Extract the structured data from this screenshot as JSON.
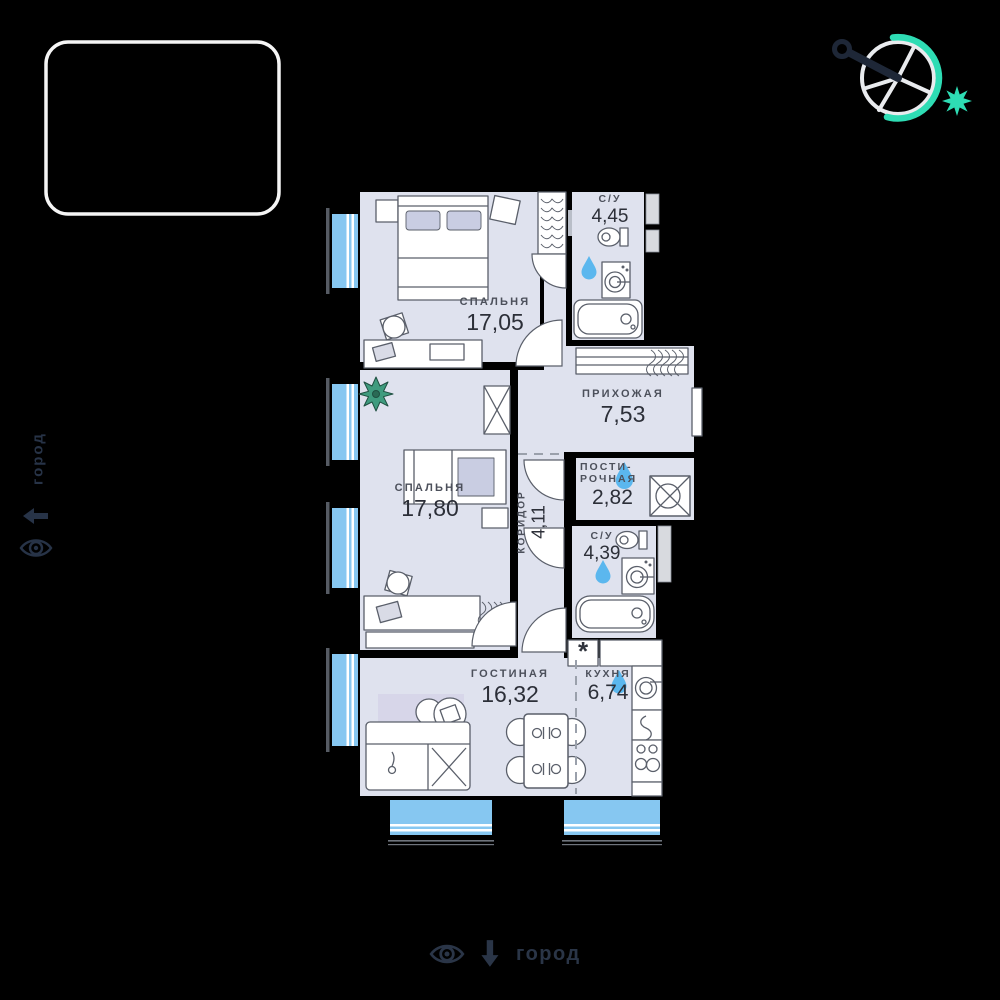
{
  "canvas": {
    "background": "#000000"
  },
  "compass": {
    "accent_color": "#2edcb4",
    "ring_color": "#e9ebee",
    "needle_color": "#1e2737"
  },
  "view_labels": {
    "left": {
      "text": "город"
    },
    "bottom": {
      "text": "город"
    }
  },
  "floorplan": {
    "colors": {
      "floor": "#dfe2ee",
      "wall": "#000000",
      "window": "#86c7f1",
      "water_drop": "#5bb7ee",
      "rug": "#d7d6e9",
      "plant": "#3f9b7e",
      "furniture_line": "#5a5f6a",
      "room_label": "#4c505b",
      "room_area": "#2c2f38"
    },
    "rooms": {
      "bedroom1": {
        "name": "СПАЛЬНЯ",
        "area": "17,05"
      },
      "bathroom1": {
        "name": "С/У",
        "area": "4,45"
      },
      "hallway": {
        "name": "ПРИХОЖАЯ",
        "area": "7,53"
      },
      "laundry": {
        "name_line1": "ПОСТИ-",
        "name_line2": "РОЧНАЯ",
        "area": "2,82"
      },
      "bathroom2": {
        "name": "С/У",
        "area": "4,39"
      },
      "corridor": {
        "name": "КОРИДОР",
        "area": "4,11"
      },
      "bedroom2": {
        "name": "СПАЛЬНЯ",
        "area": "17,80"
      },
      "living": {
        "name": "ГОСТИНАЯ",
        "area": "16,32"
      },
      "kitchen": {
        "name": "КУХНЯ",
        "area": "6,74"
      }
    },
    "kitchen_star": "*"
  }
}
